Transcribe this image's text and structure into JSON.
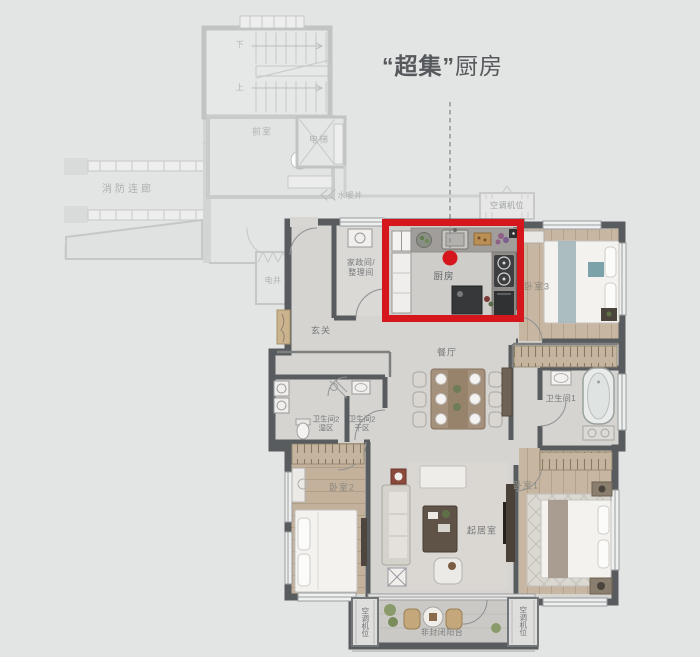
{
  "callout": {
    "quoted": "“超集”",
    "rest": "厨房"
  },
  "ghost": {
    "stairs_down": "下",
    "stairs_up": "上",
    "vestibule": "前室",
    "elevator": "电梯",
    "fire_corridor": "消防连廊",
    "water_shaft": "水暖井",
    "electric_shaft": "电井",
    "ac_top": "空调机位"
  },
  "rooms": {
    "kitchen": "厨房",
    "housekeeping_line1": "家政间/",
    "housekeeping_line2": "整理间",
    "entry": "玄关",
    "dining": "餐厅",
    "bath2_wet_line1": "卫生间2",
    "bath2_wet_line2": "湿区",
    "bath2_dry_line1": "卫生间2",
    "bath2_dry_line2": "干区",
    "bath1": "卫生间1",
    "bedroom3": "卧室3",
    "bedroom2": "卧室2",
    "bedroom1": "卧室1",
    "living": "起居室",
    "balcony": "非封闭阳台",
    "ac_left": "空调机位",
    "ac_right": "空调机位"
  },
  "colors": {
    "highlight": "#d5161d",
    "background": "#e3e4e4",
    "wall": "#595c5e"
  }
}
